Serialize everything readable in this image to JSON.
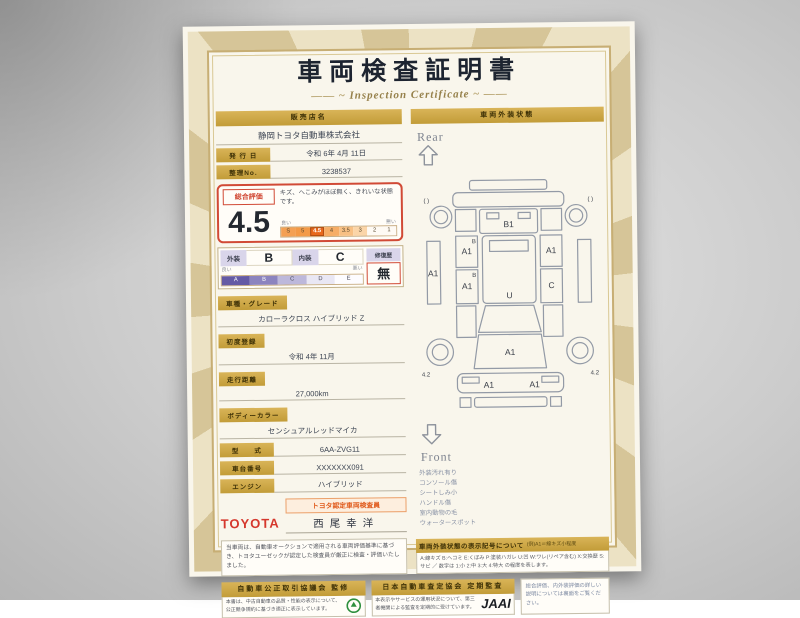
{
  "header": {
    "title": "車両検査証明書",
    "subtitle": "Inspection Certificate"
  },
  "left": {
    "dealer": {
      "label": "販売店名",
      "name": "静岡トヨタ自動車株式会社"
    },
    "issue": {
      "label": "発 行 日",
      "value": "令和 6年 4月 11日"
    },
    "serial": {
      "label": "整理No.",
      "value": "3238537"
    },
    "evaluation": {
      "label": "総合評価",
      "score": "4.5",
      "comment": "キズ、へこみがほぼ無く、きれいな状態です。",
      "scale_left": "良い",
      "scale_right": "悪い",
      "scale": [
        "S",
        "5",
        "4.5",
        "4",
        "3.5",
        "3",
        "2",
        "1"
      ]
    },
    "grades": {
      "exterior_label": "外装",
      "exterior": "B",
      "interior_label": "内装",
      "interior": "C",
      "repair_label": "修復歴",
      "repair": "無",
      "scale_left": "良い",
      "scale_right": "悪い",
      "scale": [
        "A",
        "B",
        "C",
        "D",
        "E"
      ]
    },
    "fields": [
      {
        "label": "車種・グレード",
        "value": "カローラクロス ハイブリッド Z"
      },
      {
        "label": "初度登録",
        "value": "令和 4年 11月"
      },
      {
        "label": "走行距離",
        "value": "27,000km"
      },
      {
        "label": "ボディーカラー",
        "value": "センシュアルレッドマイカ"
      },
      {
        "label": "型　　式",
        "value": "6AA-ZVG11"
      },
      {
        "label": "車台番号",
        "value": "XXXXXXX091"
      },
      {
        "label": "エンジン",
        "value": "ハイブリッド"
      }
    ],
    "inspector": {
      "badge": "トヨタ認定車両検査員",
      "brand": "TOYOTA",
      "name": "西尾幸洋"
    },
    "disclaimer": "当車両は、自動車オークションで適用される車両評価基準に基づき、トヨタユーゼックが認定した検査員が厳正に検査・評価いたしました。"
  },
  "right": {
    "header": "車両外装状態",
    "rear": "Rear",
    "front": "Front",
    "marks": {
      "rear_corner_left": "(  )",
      "rear_corner_right": "(  )",
      "rear_gate": "B1",
      "roof": "U",
      "hood": "A1",
      "front_bumper_left": "A1",
      "front_bumper_right": "A1",
      "left_sill": "A1",
      "left_door_rear": "A1",
      "left_door_front": "A1",
      "left_door_sub1": "B",
      "left_door_sub2": "B",
      "right_door_rear": "A1",
      "right_door_front": "C",
      "tire_front_left": "4.2",
      "tire_front_right": "4.2"
    },
    "notes": [
      "外装汚れ有り",
      "コンソール傷",
      "シートしみ小",
      "ハンドル傷",
      "室内動物の毛",
      "ウォータースポット"
    ],
    "legend": {
      "title": "車両外装状態の表示記号について",
      "example": "(例)A1＝線キズ小程度",
      "text": "A:線キズ B:ヘコミ E:くぼみ P:塗装ハガレ U:凹 W:ワレ(リペア含む) X:交換歴 S:サビ ／ 数字は 1:小 2:中 3:大 4:特大 の程度を表します。"
    }
  },
  "footer": {
    "fair_trade": {
      "title": "自動車公正取引協議会 監修",
      "text": "本書は、中古自動車の品質・性能の表示について、公正競争規約に基づき適正に表示しています。"
    },
    "jaai": {
      "title": "日本自動車査定協会 定期監査",
      "text": "本表示やサービスの運用状況について、第三者機関による監査を定期的に受けています。",
      "logo": "JAAI"
    },
    "note": "総合評価、内外装評価の詳しい説明については裏面をご覧ください。"
  }
}
